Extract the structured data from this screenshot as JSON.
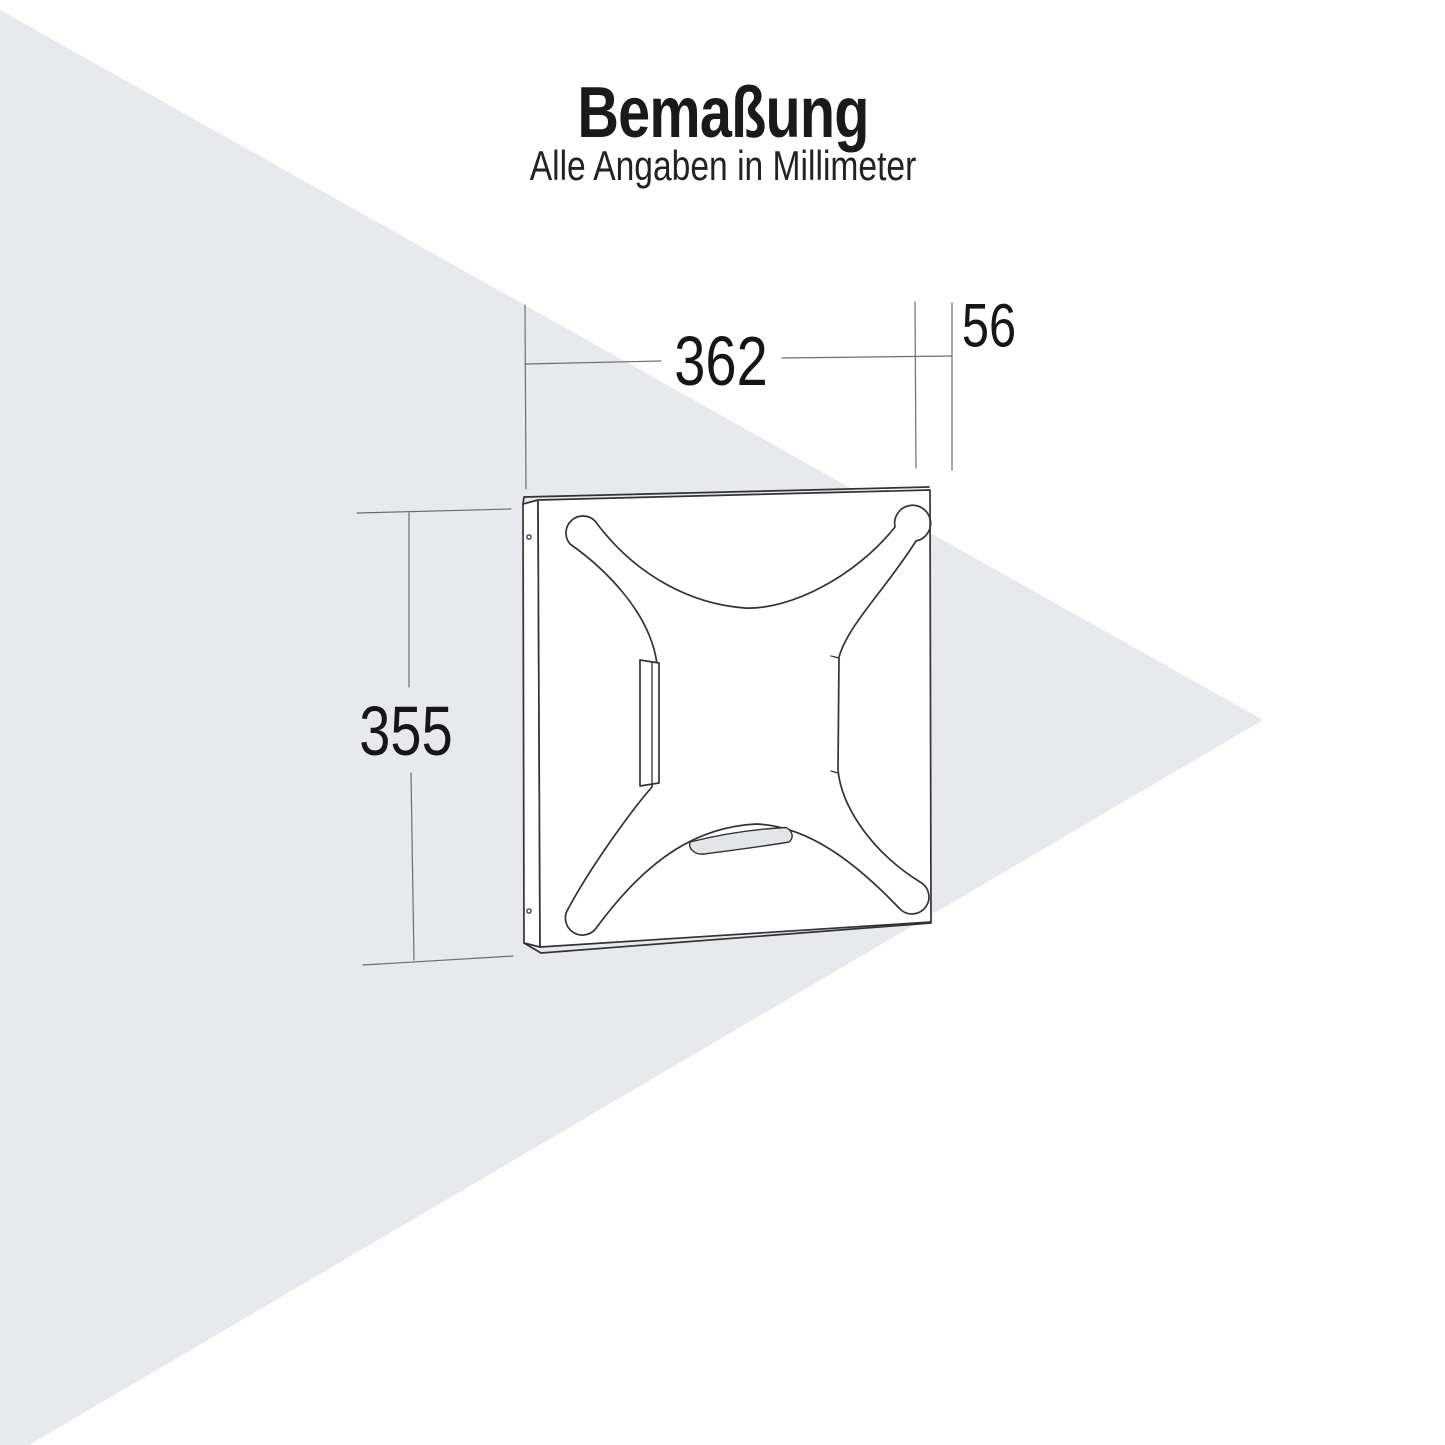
{
  "title": "Bemaßung",
  "subtitle": "Alle Angaben in Millimeter",
  "dimensions": {
    "width_mm": "362",
    "depth_mm": "56",
    "height_mm": "355"
  },
  "drawing": {
    "description": "perspective line drawing of a square mounting back panel with X-shaped recess, side clip bracket, bottom hand slot and two screw holes",
    "unit": "mm"
  },
  "colors": {
    "background": "#ffffff",
    "backdrop_triangle": "#e8e9ec",
    "drawing_line": "#333333",
    "dimension_line": "#6e6e6e",
    "slot_fill": "#e4e5e8",
    "text": "#1a1a1a"
  }
}
